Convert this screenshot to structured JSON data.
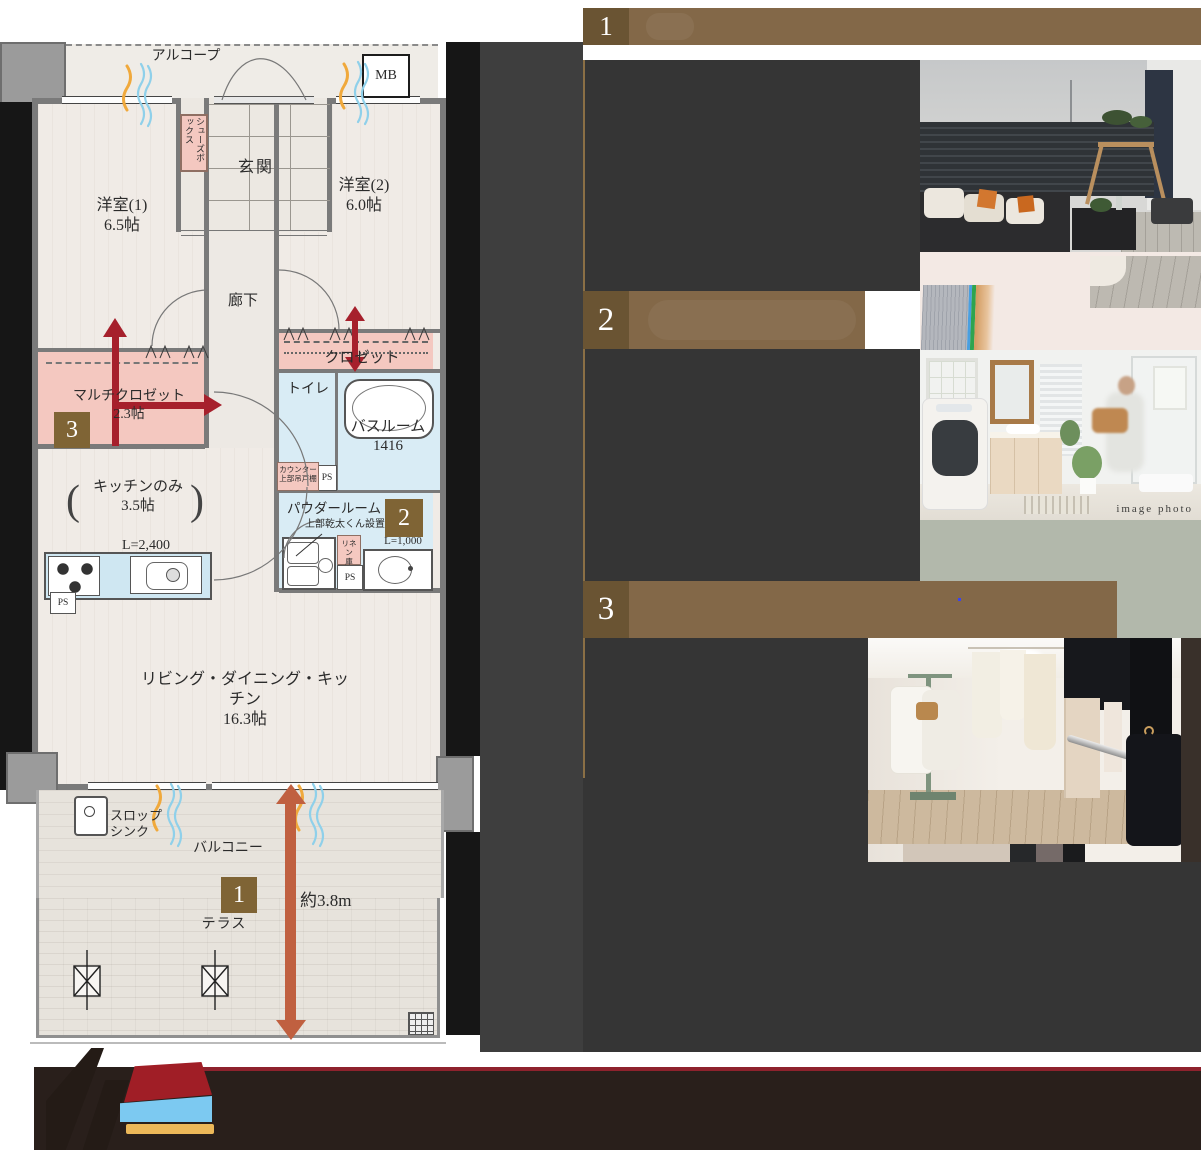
{
  "plan": {
    "alcove": "アルコープ",
    "mb": "MB",
    "entrance": "玄関",
    "shoe_box": "シューズボックス",
    "bedroom1": "洋室(1)",
    "bedroom1_size": "6.5帖",
    "bedroom2": "洋室(2)",
    "bedroom2_size": "6.0帖",
    "hallway": "廊下",
    "closet": "クロゼット",
    "multi_closet": "マルチクロゼット",
    "multi_closet_size": "2.3帖",
    "toilet": "トイレ",
    "bathroom": "バスルーム",
    "bathroom_size": "1416",
    "counter_note_line1": "カウンター",
    "counter_note_line2": "上部吊戸棚",
    "kitchen": "キッチンのみ",
    "kitchen_size": "3.5帖",
    "kitchen_length": "L=2,400",
    "paren_open": "(",
    "paren_close": ")",
    "powder_room": "パウダールーム",
    "dryer_note": "上部乾太くん設置",
    "linen_line1": "リネン",
    "linen_line2": "庫",
    "vanity_length": "L=1,000",
    "ps": "PS",
    "ldk": "リビング・ダイニング・キッチン",
    "ldk_size": "16.3帖",
    "slop_sink_line1": "スロップ",
    "slop_sink_line2": "シンク",
    "balcony": "バルコニー",
    "terrace": "テラス",
    "terrace_depth": "約3.8m",
    "badge1": "1",
    "badge2": "2",
    "badge3": "3"
  },
  "features": {
    "item1_number": "1",
    "item2_number": "2",
    "item3_number": "3"
  },
  "photo2_caption": "image photo",
  "colors": {
    "header_brown": "#836848",
    "badge_brown": "#7f6435",
    "text_block_gray": "#353535",
    "caption_pink": "#f3e9e4",
    "caption_sage": "#b2b8ab",
    "arrow_red": "#a6202c",
    "arrow_orange": "#c06040",
    "closet_pink": "#f4c8c0",
    "wet_area_blue": "#d9ecf5",
    "footer_dark": "#291f1b",
    "footer_red_line": "#8e222d",
    "logo_red": "#a01e26",
    "logo_blue": "#7cc9f1",
    "logo_yellow": "#ecb859"
  }
}
